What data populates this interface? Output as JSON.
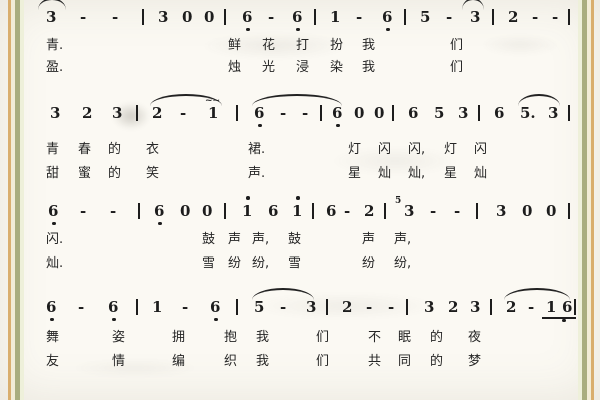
{
  "page": {
    "background": "#fbf9f3",
    "ink_color": "#1d1d1d",
    "stripe_colors": [
      "#d9ae6e",
      "#f2ecd6",
      "#a9ad7e",
      "#eef0da"
    ]
  },
  "score": {
    "systems": [
      {
        "y": 8,
        "notes": [
          {
            "t": "3",
            "x": 46
          },
          {
            "t": "-",
            "x": 80
          },
          {
            "t": "-",
            "x": 112
          },
          {
            "t": "|",
            "x": 142
          },
          {
            "t": "3",
            "x": 158
          },
          {
            "t": "0",
            "x": 182
          },
          {
            "t": "0",
            "x": 204
          },
          {
            "t": "|",
            "x": 224
          },
          {
            "t": "6",
            "x": 242,
            "dot": "b"
          },
          {
            "t": "-",
            "x": 268
          },
          {
            "t": "6",
            "x": 292,
            "dot": "b"
          },
          {
            "t": "|",
            "x": 314
          },
          {
            "t": "1",
            "x": 330
          },
          {
            "t": "-",
            "x": 356
          },
          {
            "t": "6",
            "x": 382,
            "dot": "b"
          },
          {
            "t": "|",
            "x": 404
          },
          {
            "t": "5",
            "x": 420
          },
          {
            "t": "-",
            "x": 446
          },
          {
            "t": "3",
            "x": 470
          },
          {
            "t": "|",
            "x": 492
          },
          {
            "t": "2",
            "x": 508
          },
          {
            "t": "-",
            "x": 532
          },
          {
            "t": "-",
            "x": 552
          },
          {
            "t": "|",
            "x": 568
          }
        ],
        "arcs": [
          {
            "x1": 38,
            "x2": 66
          },
          {
            "x1": 462,
            "x2": 484
          }
        ],
        "lyrics": [
          {
            "dy": 30,
            "segs": [
              [
                46,
                "青."
              ],
              [
                228,
                "鲜"
              ],
              [
                262,
                "花"
              ],
              [
                296,
                "打"
              ],
              [
                330,
                "扮"
              ],
              [
                362,
                "我"
              ],
              [
                450,
                "们"
              ]
            ]
          },
          {
            "dy": 52,
            "segs": [
              [
                46,
                "盈."
              ],
              [
                228,
                "烛"
              ],
              [
                262,
                "光"
              ],
              [
                296,
                "浸"
              ],
              [
                330,
                "染"
              ],
              [
                362,
                "我"
              ],
              [
                450,
                "们"
              ]
            ]
          }
        ]
      },
      {
        "y": 104,
        "notes": [
          {
            "t": "3",
            "x": 50
          },
          {
            "t": "2",
            "x": 82
          },
          {
            "t": "3",
            "x": 112
          },
          {
            "t": "|",
            "x": 136
          },
          {
            "t": "2",
            "x": 152
          },
          {
            "t": "-",
            "x": 180
          },
          {
            "t": "1",
            "x": 208,
            "orn": "~~"
          },
          {
            "t": "|",
            "x": 236
          },
          {
            "t": "6",
            "x": 254,
            "dot": "b"
          },
          {
            "t": "-",
            "x": 280
          },
          {
            "t": "-",
            "x": 302
          },
          {
            "t": "|",
            "x": 320
          },
          {
            "t": "6",
            "x": 332,
            "dot": "b"
          },
          {
            "t": "0",
            "x": 354
          },
          {
            "t": "0",
            "x": 374
          },
          {
            "t": "|",
            "x": 392
          },
          {
            "t": "6",
            "x": 408
          },
          {
            "t": "5",
            "x": 434
          },
          {
            "t": "3",
            "x": 458
          },
          {
            "t": "|",
            "x": 478
          },
          {
            "t": "6",
            "x": 494
          },
          {
            "t": "5.",
            "x": 520
          },
          {
            "t": "3",
            "x": 548
          },
          {
            "t": "|",
            "x": 568
          }
        ],
        "arcs": [
          {
            "x1": 150,
            "x2": 222
          },
          {
            "x1": 252,
            "x2": 342
          },
          {
            "x1": 518,
            "x2": 560
          }
        ],
        "lyrics": [
          {
            "dy": 38,
            "segs": [
              [
                46,
                "青"
              ],
              [
                78,
                "春"
              ],
              [
                108,
                "的"
              ],
              [
                146,
                "衣"
              ],
              [
                248,
                "裙."
              ],
              [
                348,
                "灯"
              ],
              [
                378,
                "闪"
              ],
              [
                408,
                "闪,"
              ],
              [
                444,
                "灯"
              ],
              [
                474,
                "闪"
              ]
            ]
          },
          {
            "dy": 62,
            "segs": [
              [
                46,
                "甜"
              ],
              [
                78,
                "蜜"
              ],
              [
                108,
                "的"
              ],
              [
                146,
                "笑"
              ],
              [
                248,
                "声."
              ],
              [
                348,
                "星"
              ],
              [
                378,
                "灿"
              ],
              [
                408,
                "灿,"
              ],
              [
                444,
                "星"
              ],
              [
                474,
                "灿"
              ]
            ]
          }
        ]
      },
      {
        "y": 202,
        "notes": [
          {
            "t": "6",
            "x": 48,
            "dot": "b"
          },
          {
            "t": "-",
            "x": 80
          },
          {
            "t": "-",
            "x": 110
          },
          {
            "t": "|",
            "x": 138
          },
          {
            "t": "6",
            "x": 154,
            "dot": "b"
          },
          {
            "t": "0",
            "x": 180
          },
          {
            "t": "0",
            "x": 202
          },
          {
            "t": "|",
            "x": 224
          },
          {
            "t": "1",
            "x": 242,
            "dot": "a"
          },
          {
            "t": "6",
            "x": 268
          },
          {
            "t": "1",
            "x": 292,
            "dot": "a"
          },
          {
            "t": "|",
            "x": 312
          },
          {
            "t": "6",
            "x": 326
          },
          {
            "t": "-",
            "x": 344
          },
          {
            "t": "2",
            "x": 364
          },
          {
            "t": "|",
            "x": 384
          },
          {
            "t": "3",
            "x": 404,
            "grace": "5"
          },
          {
            "t": "-",
            "x": 430
          },
          {
            "t": "-",
            "x": 454
          },
          {
            "t": "|",
            "x": 476
          },
          {
            "t": "3",
            "x": 496
          },
          {
            "t": "0",
            "x": 522
          },
          {
            "t": "0",
            "x": 546
          },
          {
            "t": "|",
            "x": 568
          }
        ],
        "arcs": [],
        "lyrics": [
          {
            "dy": 30,
            "segs": [
              [
                46,
                "闪."
              ],
              [
                202,
                "鼓"
              ],
              [
                228,
                "声"
              ],
              [
                252,
                "声,"
              ],
              [
                288,
                "鼓"
              ],
              [
                362,
                "声"
              ],
              [
                394,
                "声,"
              ]
            ]
          },
          {
            "dy": 54,
            "segs": [
              [
                46,
                "灿."
              ],
              [
                202,
                "雪"
              ],
              [
                228,
                "纷"
              ],
              [
                252,
                "纷,"
              ],
              [
                288,
                "雪"
              ],
              [
                362,
                "纷"
              ],
              [
                394,
                "纷,"
              ]
            ]
          }
        ]
      },
      {
        "y": 298,
        "notes": [
          {
            "t": "6",
            "x": 46,
            "dot": "b"
          },
          {
            "t": "-",
            "x": 78
          },
          {
            "t": "6",
            "x": 108,
            "dot": "b"
          },
          {
            "t": "|",
            "x": 136
          },
          {
            "t": "1",
            "x": 152
          },
          {
            "t": "-",
            "x": 182
          },
          {
            "t": "6",
            "x": 210,
            "dot": "b"
          },
          {
            "t": "|",
            "x": 236
          },
          {
            "t": "5",
            "x": 254
          },
          {
            "t": "-",
            "x": 280
          },
          {
            "t": "3",
            "x": 306
          },
          {
            "t": "|",
            "x": 326
          },
          {
            "t": "2",
            "x": 342
          },
          {
            "t": "-",
            "x": 366
          },
          {
            "t": "-",
            "x": 388
          },
          {
            "t": "|",
            "x": 406
          },
          {
            "t": "3",
            "x": 424
          },
          {
            "t": "2",
            "x": 448
          },
          {
            "t": "3",
            "x": 470
          },
          {
            "t": "|",
            "x": 490
          },
          {
            "t": "2",
            "x": 506
          },
          {
            "t": "-",
            "x": 528
          },
          {
            "t": "1",
            "x": 546,
            "u": true
          },
          {
            "t": "6",
            "x": 562,
            "u": true,
            "dot": "b"
          },
          {
            "t": "|",
            "x": 574
          }
        ],
        "arcs": [
          {
            "x1": 252,
            "x2": 314
          },
          {
            "x1": 504,
            "x2": 570
          }
        ],
        "lyrics": [
          {
            "dy": 32,
            "segs": [
              [
                46,
                "舞"
              ],
              [
                112,
                "姿"
              ],
              [
                172,
                "拥"
              ],
              [
                224,
                "抱"
              ],
              [
                256,
                "我"
              ],
              [
                316,
                "们"
              ],
              [
                368,
                "不"
              ],
              [
                398,
                "眠"
              ],
              [
                430,
                "的"
              ],
              [
                468,
                "夜"
              ]
            ]
          },
          {
            "dy": 56,
            "segs": [
              [
                46,
                "友"
              ],
              [
                112,
                "情"
              ],
              [
                172,
                "编"
              ],
              [
                224,
                "织"
              ],
              [
                256,
                "我"
              ],
              [
                316,
                "们"
              ],
              [
                368,
                "共"
              ],
              [
                398,
                "同"
              ],
              [
                430,
                "的"
              ],
              [
                468,
                "梦"
              ]
            ]
          }
        ]
      }
    ]
  }
}
